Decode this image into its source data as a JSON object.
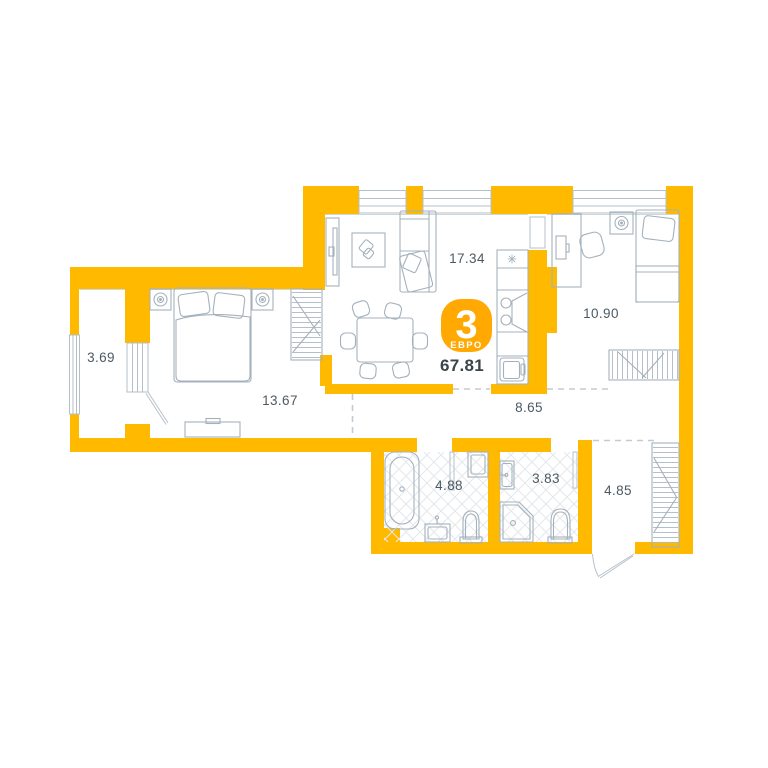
{
  "floorplan": {
    "badge": {
      "rooms_count": "3",
      "layout_type": "ЕВРО",
      "total_area": "67.81"
    },
    "rooms": [
      {
        "name": "balcony",
        "area": "3.69"
      },
      {
        "name": "bedroom-1",
        "area": "13.67"
      },
      {
        "name": "living-kitchen",
        "area": "17.34"
      },
      {
        "name": "bedroom-2",
        "area": "10.90"
      },
      {
        "name": "corridor",
        "area": "8.65"
      },
      {
        "name": "bathroom",
        "area": "4.88"
      },
      {
        "name": "toilet",
        "area": "3.83"
      },
      {
        "name": "hallway",
        "area": "4.85"
      }
    ],
    "colors": {
      "wall": "#FFBA00",
      "badge": "#FFA902",
      "furniture_line": "#A4B1BC",
      "label_text": "#4D5962",
      "total_text": "#3B4449"
    },
    "icons": [
      "window",
      "balcony-door",
      "entrance-door",
      "double-bed",
      "single-bed",
      "nightstand-lamp",
      "wardrobe",
      "tv-stand",
      "tv-unit",
      "armchair",
      "corner-sofa",
      "dining-table",
      "chair",
      "kitchen-counter",
      "stove",
      "kitchen-sink",
      "fridge-niche",
      "desk",
      "desk-chair",
      "bathtub",
      "washing-machine",
      "washbasin",
      "toilet",
      "corner-shower"
    ]
  }
}
